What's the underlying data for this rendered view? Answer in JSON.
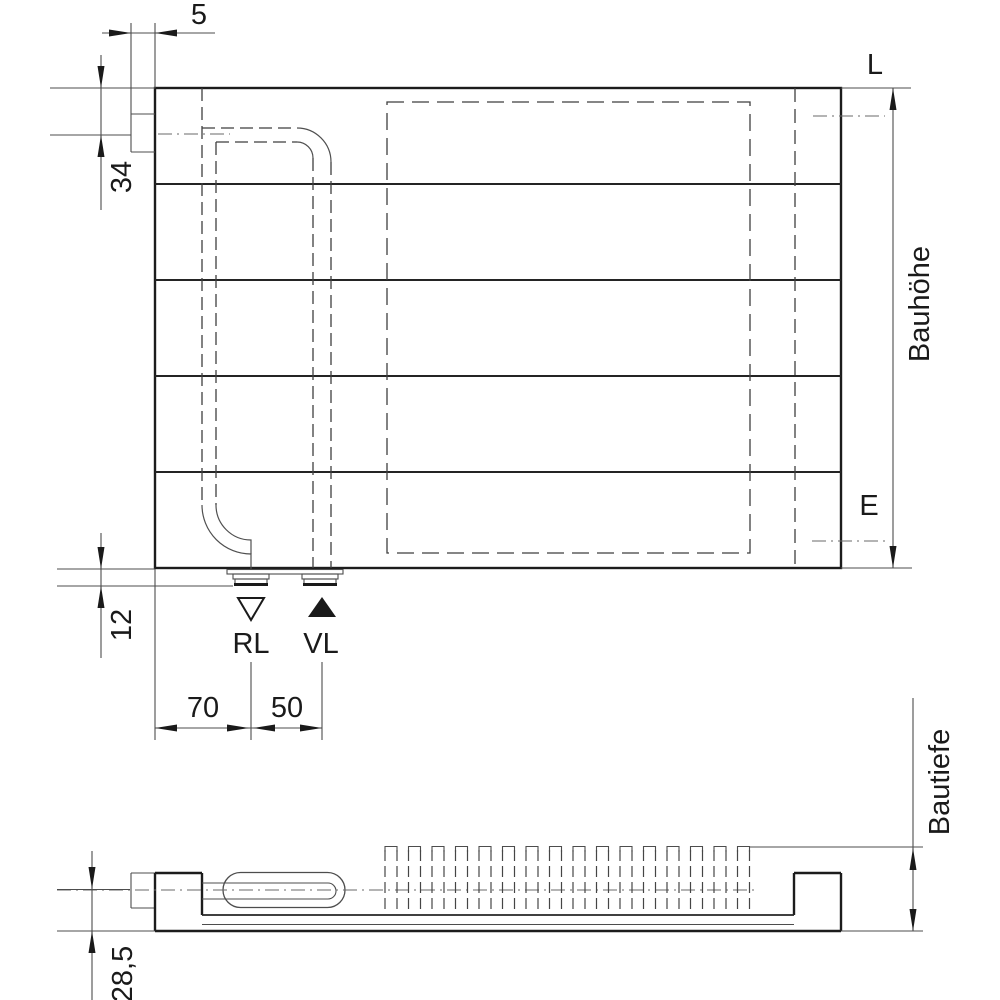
{
  "drawing": {
    "type": "radiator-technical-dimension-drawing",
    "background_color": "#ffffff",
    "line_color": "#1c1c1c",
    "thin_line_color": "#4d4d4d",
    "labels": {
      "dim_tab_offset": "5",
      "dim_inlet_from_top": "34",
      "connection_top_mark": "L",
      "height_label": "Bauhöhe",
      "connection_bottom_mark": "E",
      "dim_stub_height": "12",
      "return_label": "RL",
      "flow_label": "VL",
      "dim_edge_to_rl": "70",
      "dim_rl_to_vl": "50",
      "depth_label": "Bautiefe",
      "dim_depth_detail": "28,5"
    },
    "icons": {
      "return_direction": "hollow-triangle-down",
      "flow_direction": "filled-triangle-up"
    },
    "views": {
      "front_view_panels": 5,
      "bottom_view_fins": 16
    }
  }
}
